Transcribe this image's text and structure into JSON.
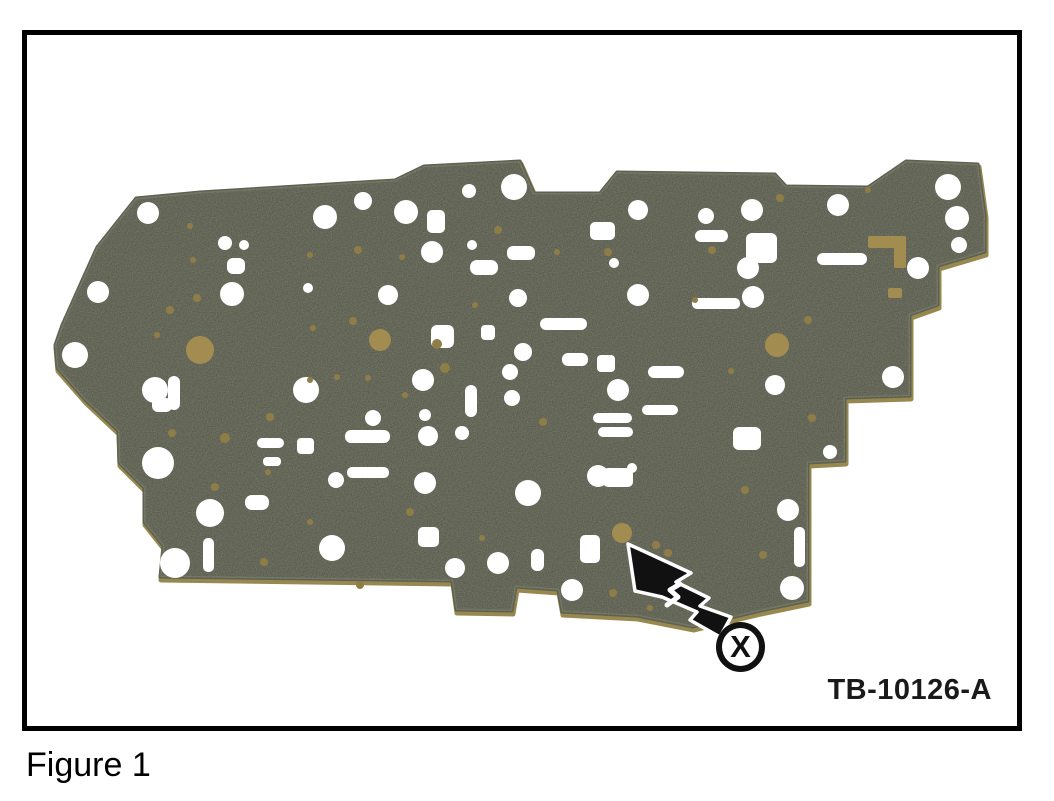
{
  "figure": {
    "caption": "Figure 1",
    "ref_label": "TB-10126-A",
    "callout": "X"
  },
  "colors": {
    "background": "#ffffff",
    "frame": "#000000",
    "plate": "#4b4e40",
    "plate_edge": "#5e6050",
    "plate_rim": "#96884f",
    "hole": "#ffffff",
    "gold": "#a38c50",
    "gold_dot": "#8f7d48",
    "arrow": "#111111"
  },
  "photo": {
    "outline": [
      [
        136,
        198
      ],
      [
        200,
        192
      ],
      [
        395,
        180
      ],
      [
        424,
        166
      ],
      [
        520,
        161
      ],
      [
        534,
        193
      ],
      [
        600,
        193
      ],
      [
        617,
        172
      ],
      [
        775,
        174
      ],
      [
        786,
        186
      ],
      [
        868,
        187
      ],
      [
        906,
        161
      ],
      [
        978,
        164
      ],
      [
        985,
        215
      ],
      [
        985,
        252
      ],
      [
        938,
        266
      ],
      [
        938,
        305
      ],
      [
        910,
        315
      ],
      [
        910,
        396
      ],
      [
        845,
        398
      ],
      [
        845,
        461
      ],
      [
        808,
        463
      ],
      [
        808,
        601
      ],
      [
        760,
        611
      ],
      [
        693,
        627
      ],
      [
        637,
        616
      ],
      [
        562,
        612
      ],
      [
        558,
        590
      ],
      [
        516,
        587
      ],
      [
        512,
        611
      ],
      [
        456,
        610
      ],
      [
        452,
        581
      ],
      [
        160,
        577
      ],
      [
        163,
        546
      ],
      [
        144,
        522
      ],
      [
        144,
        488
      ],
      [
        119,
        463
      ],
      [
        118,
        431
      ],
      [
        85,
        400
      ],
      [
        57,
        368
      ],
      [
        55,
        345
      ],
      [
        62,
        325
      ],
      [
        83,
        278
      ],
      [
        97,
        247
      ]
    ],
    "white_circles": [
      [
        148,
        213,
        11
      ],
      [
        98,
        292,
        11
      ],
      [
        75,
        355,
        13
      ],
      [
        155,
        390,
        13
      ],
      [
        158,
        463,
        16
      ],
      [
        175,
        563,
        15
      ],
      [
        210,
        513,
        14
      ],
      [
        225,
        243,
        7
      ],
      [
        244,
        245,
        5
      ],
      [
        232,
        294,
        12
      ],
      [
        308,
        288,
        5
      ],
      [
        325,
        217,
        12
      ],
      [
        363,
        201,
        9
      ],
      [
        406,
        212,
        12
      ],
      [
        432,
        252,
        11
      ],
      [
        472,
        245,
        5
      ],
      [
        388,
        295,
        10
      ],
      [
        373,
        418,
        8
      ],
      [
        423,
        380,
        11
      ],
      [
        425,
        415,
        6
      ],
      [
        428,
        436,
        10
      ],
      [
        462,
        433,
        7
      ],
      [
        332,
        548,
        13
      ],
      [
        425,
        483,
        11
      ],
      [
        455,
        568,
        10
      ],
      [
        469,
        191,
        7
      ],
      [
        514,
        187,
        13
      ],
      [
        518,
        298,
        9
      ],
      [
        523,
        352,
        9
      ],
      [
        510,
        372,
        8
      ],
      [
        512,
        398,
        8
      ],
      [
        498,
        563,
        11
      ],
      [
        528,
        493,
        13
      ],
      [
        572,
        590,
        11
      ],
      [
        598,
        476,
        11
      ],
      [
        618,
        390,
        11
      ],
      [
        638,
        210,
        10
      ],
      [
        706,
        216,
        8
      ],
      [
        752,
        210,
        11
      ],
      [
        748,
        268,
        11
      ],
      [
        753,
        297,
        11
      ],
      [
        638,
        295,
        11
      ],
      [
        614,
        263,
        5
      ],
      [
        632,
        468,
        5
      ],
      [
        775,
        385,
        10
      ],
      [
        788,
        510,
        11
      ],
      [
        792,
        588,
        12
      ],
      [
        830,
        452,
        7
      ],
      [
        838,
        205,
        11
      ],
      [
        893,
        377,
        11
      ],
      [
        918,
        268,
        11
      ],
      [
        948,
        187,
        13
      ],
      [
        957,
        218,
        12
      ],
      [
        959,
        245,
        8
      ],
      [
        306,
        390,
        13
      ],
      [
        336,
        480,
        8
      ]
    ],
    "white_slots": [
      [
        470,
        260,
        28,
        15,
        7
      ],
      [
        507,
        246,
        28,
        14,
        6
      ],
      [
        427,
        210,
        18,
        23,
        5
      ],
      [
        590,
        222,
        25,
        18,
        5
      ],
      [
        695,
        230,
        33,
        12,
        6
      ],
      [
        692,
        298,
        48,
        11,
        5
      ],
      [
        817,
        253,
        50,
        12,
        6
      ],
      [
        746,
        233,
        31,
        30,
        6
      ],
      [
        345,
        430,
        45,
        13,
        6
      ],
      [
        347,
        467,
        42,
        11,
        5
      ],
      [
        465,
        385,
        12,
        32,
        6
      ],
      [
        540,
        318,
        47,
        12,
        6
      ],
      [
        562,
        353,
        26,
        13,
        6
      ],
      [
        597,
        355,
        18,
        17,
        4
      ],
      [
        593,
        413,
        39,
        10,
        5
      ],
      [
        598,
        427,
        35,
        10,
        5
      ],
      [
        642,
        405,
        36,
        10,
        5
      ],
      [
        648,
        366,
        36,
        12,
        6
      ],
      [
        603,
        468,
        30,
        19,
        5
      ],
      [
        297,
        438,
        17,
        16,
        4
      ],
      [
        418,
        527,
        21,
        20,
        5
      ],
      [
        245,
        495,
        24,
        15,
        7
      ],
      [
        203,
        538,
        11,
        34,
        5
      ],
      [
        531,
        549,
        13,
        22,
        6
      ],
      [
        580,
        535,
        20,
        28,
        5
      ],
      [
        794,
        527,
        11,
        40,
        5
      ],
      [
        733,
        427,
        28,
        23,
        6
      ],
      [
        257,
        438,
        27,
        10,
        5
      ],
      [
        263,
        457,
        18,
        9,
        4
      ],
      [
        227,
        258,
        18,
        16,
        6
      ],
      [
        168,
        376,
        12,
        34,
        6
      ],
      [
        152,
        398,
        20,
        14,
        6
      ],
      [
        431,
        325,
        23,
        23,
        6
      ],
      [
        481,
        325,
        14,
        15,
        4
      ]
    ],
    "gold_circles": [
      [
        200,
        350,
        14
      ],
      [
        380,
        340,
        11
      ],
      [
        777,
        345,
        12
      ],
      [
        622,
        533,
        10
      ]
    ],
    "gold_dots": [
      [
        353,
        321,
        4
      ],
      [
        337,
        377,
        3
      ],
      [
        368,
        378,
        3
      ],
      [
        445,
        368,
        5
      ],
      [
        543,
        422,
        4
      ],
      [
        656,
        545,
        4
      ],
      [
        264,
        562,
        4
      ],
      [
        410,
        512,
        4
      ],
      [
        215,
        487,
        4
      ],
      [
        172,
        433,
        4
      ],
      [
        498,
        230,
        4
      ],
      [
        557,
        252,
        3
      ],
      [
        608,
        252,
        4
      ],
      [
        780,
        198,
        4
      ],
      [
        868,
        190,
        3
      ],
      [
        712,
        250,
        4
      ],
      [
        808,
        320,
        4
      ],
      [
        812,
        418,
        4
      ],
      [
        745,
        490,
        4
      ],
      [
        763,
        555,
        4
      ],
      [
        613,
        593,
        4
      ],
      [
        650,
        608,
        3
      ],
      [
        482,
        538,
        3
      ],
      [
        197,
        298,
        4
      ],
      [
        157,
        335,
        3
      ],
      [
        268,
        472,
        3
      ],
      [
        360,
        585,
        4
      ],
      [
        310,
        522,
        3
      ],
      [
        358,
        250,
        4
      ],
      [
        310,
        380,
        3
      ],
      [
        405,
        395,
        3
      ],
      [
        668,
        553,
        4
      ],
      [
        695,
        300,
        3
      ],
      [
        190,
        226,
        3
      ],
      [
        193,
        260,
        3
      ],
      [
        310,
        255,
        3
      ],
      [
        402,
        257,
        3
      ],
      [
        475,
        305,
        3
      ],
      [
        270,
        417,
        4
      ],
      [
        225,
        438,
        5
      ],
      [
        313,
        328,
        3
      ],
      [
        170,
        310,
        4
      ],
      [
        731,
        371,
        3
      ],
      [
        437,
        344,
        5
      ]
    ],
    "gold_rects": [
      [
        868,
        236,
        38,
        12
      ],
      [
        894,
        236,
        12,
        32
      ],
      [
        888,
        288,
        14,
        10
      ]
    ],
    "arrow": {
      "points": [
        [
          628,
          544
        ],
        [
          691,
          573
        ],
        [
          676,
          582
        ],
        [
          709,
          598
        ],
        [
          700,
          606
        ],
        [
          731,
          617
        ],
        [
          720,
          637
        ],
        [
          690,
          620
        ],
        [
          697,
          612
        ],
        [
          662,
          597
        ],
        [
          635,
          591
        ]
      ],
      "break_line": [
        [
          680,
          584
        ],
        [
          670,
          590
        ],
        [
          678,
          597
        ],
        [
          667,
          605
        ]
      ]
    }
  }
}
